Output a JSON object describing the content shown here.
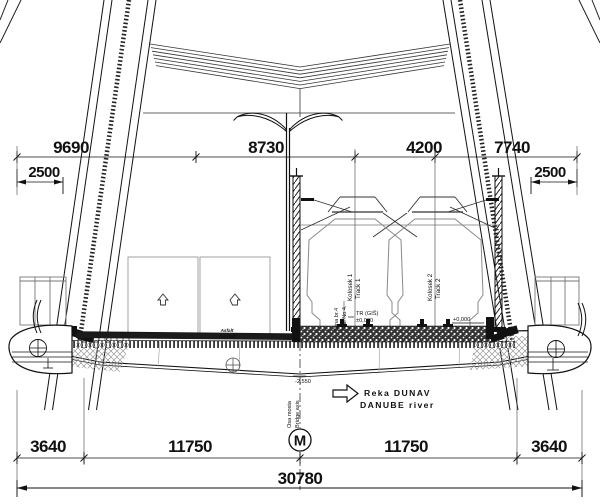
{
  "drawing_title": "Bridge deck cross-section over the Danube",
  "dims": {
    "top": [
      "9690",
      "8730",
      "4200",
      "7740"
    ],
    "side_left": "2500",
    "side_right": "2500",
    "bottom": [
      "3640",
      "11750",
      "11750",
      "3640"
    ],
    "total": "30780"
  },
  "labels": {
    "rail4_line1": "Šina br.4",
    "rail4_line2": "Rail No 4.",
    "track1_line1": "Kolosek 1",
    "track1_line2": "Track 1",
    "track2_line1": "Kolosek 2",
    "track2_line2": "Track 2",
    "axis_line1": "Osa mosta",
    "axis_line2": "Bridge axis",
    "asphalt_line1": "Asfalt",
    "asphalt_line2": "Asphalt",
    "river_line1": "Reka DUNAV",
    "river_line2": "DANUBE river",
    "level_tr": "TR (GIŠ)",
    "level_zero": "±0,000",
    "level_zero_right": "+0,000",
    "level_low": "-2,550",
    "monument": "M"
  },
  "colors": {
    "line": "#111111",
    "light_line": "#8a8a8a",
    "background": "#ffffff"
  }
}
